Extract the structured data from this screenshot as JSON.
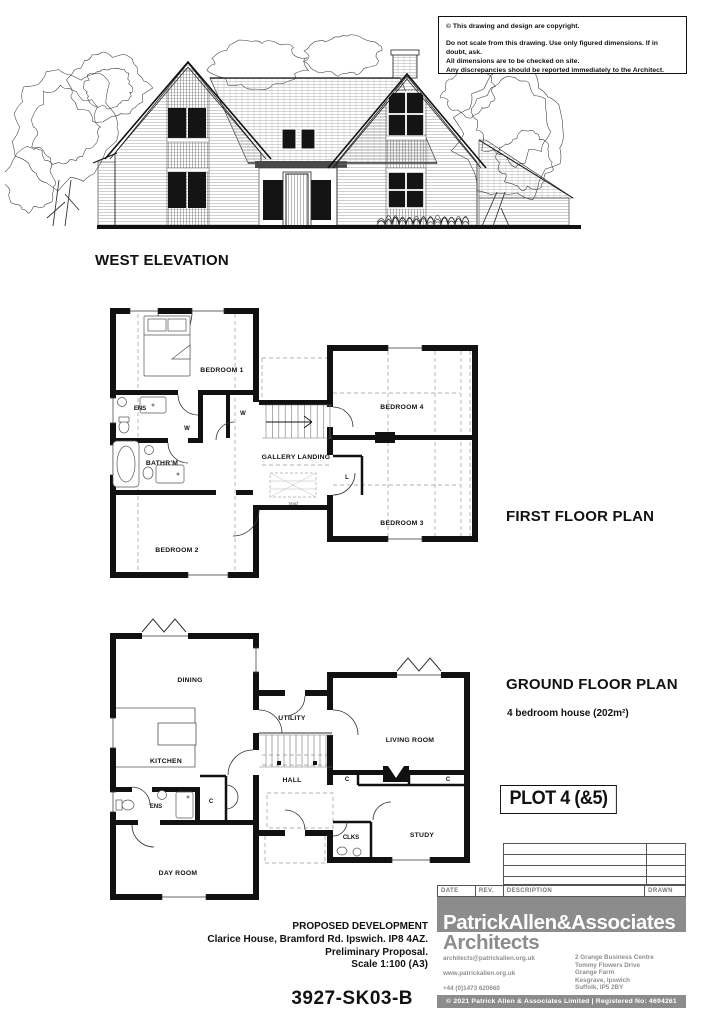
{
  "notice": {
    "line1": "© This drawing and design are copyright.",
    "line2": "Do not scale from this drawing. Use only figured dimensions. If in doubt, ask.",
    "line3": "All dimensions are to be checked on site.",
    "line4": "Any discrepancies should be reported immediately to the Architect."
  },
  "elevation": {
    "title": "WEST ELEVATION"
  },
  "first_floor": {
    "title": "FIRST FLOOR PLAN",
    "rooms": {
      "bedroom1": "BEDROOM 1",
      "bedroom2": "BEDROOM 2",
      "bedroom3": "BEDROOM 3",
      "bedroom4": "BEDROOM 4",
      "ens": "ENS",
      "bathroom": "BATHR'M",
      "landing": "GALLERY LANDING",
      "w1": "W",
      "w2": "W",
      "linen": "L",
      "void": "Void"
    }
  },
  "ground_floor": {
    "title": "GROUND FLOOR PLAN",
    "subtitle": "4 bedroom house  (202m²)",
    "plot": "PLOT 4 (&5)",
    "rooms": {
      "dining": "DINING",
      "kitchen": "KITCHEN",
      "utility": "UTILITY",
      "hall": "HALL",
      "ens": "ENS",
      "dayroom": "DAY ROOM",
      "living": "LIVING ROOM",
      "clks": "CLKS",
      "study": "STUDY",
      "c1": "C",
      "c2": "C",
      "c3": "C"
    }
  },
  "revision_table": {
    "date": "DATE",
    "rev": "REV.",
    "description": "DESCRIPTION",
    "drawn": "DRAWN"
  },
  "project": {
    "title": "PROPOSED DEVELOPMENT",
    "address": "Clarice House, Bramford Rd. Ipswich. IP8 4AZ.",
    "status": "Preliminary Proposal.",
    "scale": "Scale 1:100 (A3)",
    "number": "3927-SK03-B"
  },
  "firm": {
    "name": "PatrickAllen&Associates",
    "profession": "Architects",
    "email": "architects@patrickallen.org.uk",
    "website": "www.patrickallen.org.uk",
    "phone": "+44 (0)1473 620660",
    "address_lines": [
      "2 Grange Business Centre",
      "Tommy Flowers Drive",
      "Grange Farm",
      "Kesgrave, Ipswich",
      "Suffolk, IP5 2BY"
    ],
    "copyright": "© 2021 Patrick Allen & Associates Limited  |  Registered No: 4694261"
  },
  "colors": {
    "band_gray": "#8c8c8c",
    "ink": "#111111",
    "dash_gray": "#999999"
  }
}
